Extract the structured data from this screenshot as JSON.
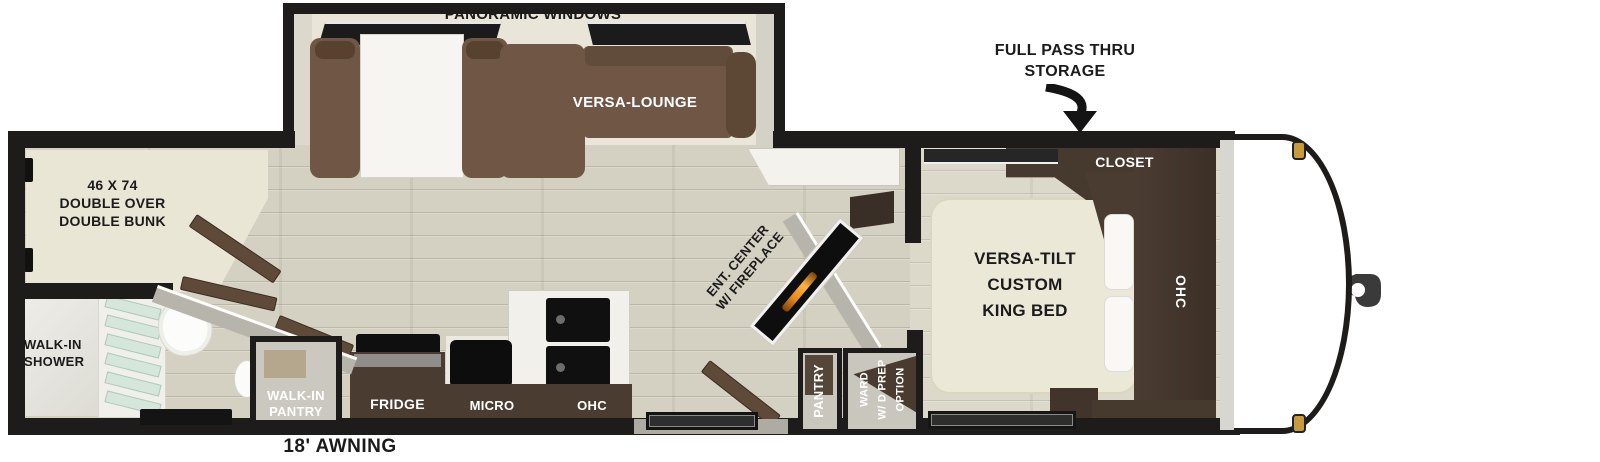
{
  "labels": {
    "panoramic_windows": "PANORAMIC WINDOWS",
    "versa_lounge": "VERSA-LOUNGE",
    "storage_line1": "FULL PASS THRU",
    "storage_line2": "STORAGE",
    "bunk_line1": "46 X 74",
    "bunk_line2": "DOUBLE OVER",
    "bunk_line3": "DOUBLE BUNK",
    "shower_line1": "WALK-IN",
    "shower_line2": "SHOWER",
    "walkin_pantry_line1": "WALK-IN",
    "walkin_pantry_line2": "PANTRY",
    "fridge": "FRIDGE",
    "micro": "MICRO",
    "kitchen_ohc": "OHC",
    "ent_line1": "ENT. CENTER",
    "ent_line2": "W/ FIREPLACE",
    "pantry": "PANTRY",
    "ward_line1": "WARD",
    "ward_line2": "W/ D PREP",
    "ward_line3": "OPTION",
    "closet": "CLOSET",
    "bedroom_ohc": "OHC",
    "bed_line1": "VERSA-TILT",
    "bed_line2": "CUSTOM",
    "bed_line3": "KING BED",
    "awning": "18' AWNING"
  },
  "colors": {
    "wall": "#1d1c1a",
    "floor": "#d5d1c2",
    "floor_bedroom": "#ddd9ca",
    "interior_wall": "#e9e5d8",
    "sofa_brown": "#6f5645",
    "cabinet_brown": "#4a3c31",
    "bed_cream": "#ece8d8",
    "glass_green": "#d5e7db",
    "fireplace_orange": "#e78c1e",
    "marker_amber": "#c89a3e"
  }
}
